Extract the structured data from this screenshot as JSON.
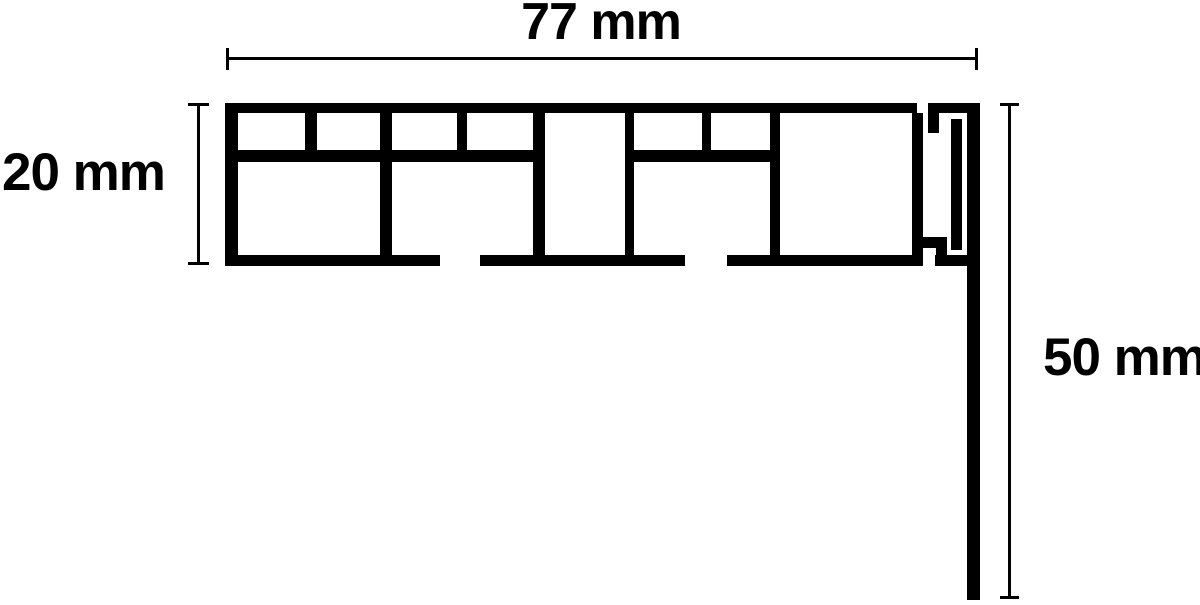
{
  "diagram": {
    "type": "profile-cross-section-technical-drawing",
    "unit": "mm",
    "dimensions": {
      "width": {
        "value": 77,
        "label": "77 mm"
      },
      "height": {
        "value": 20,
        "label": "20 mm"
      },
      "drop": {
        "value": 50,
        "label": "50 mm"
      }
    },
    "colors": {
      "stroke": "#000000",
      "background": "#ffffff"
    }
  }
}
